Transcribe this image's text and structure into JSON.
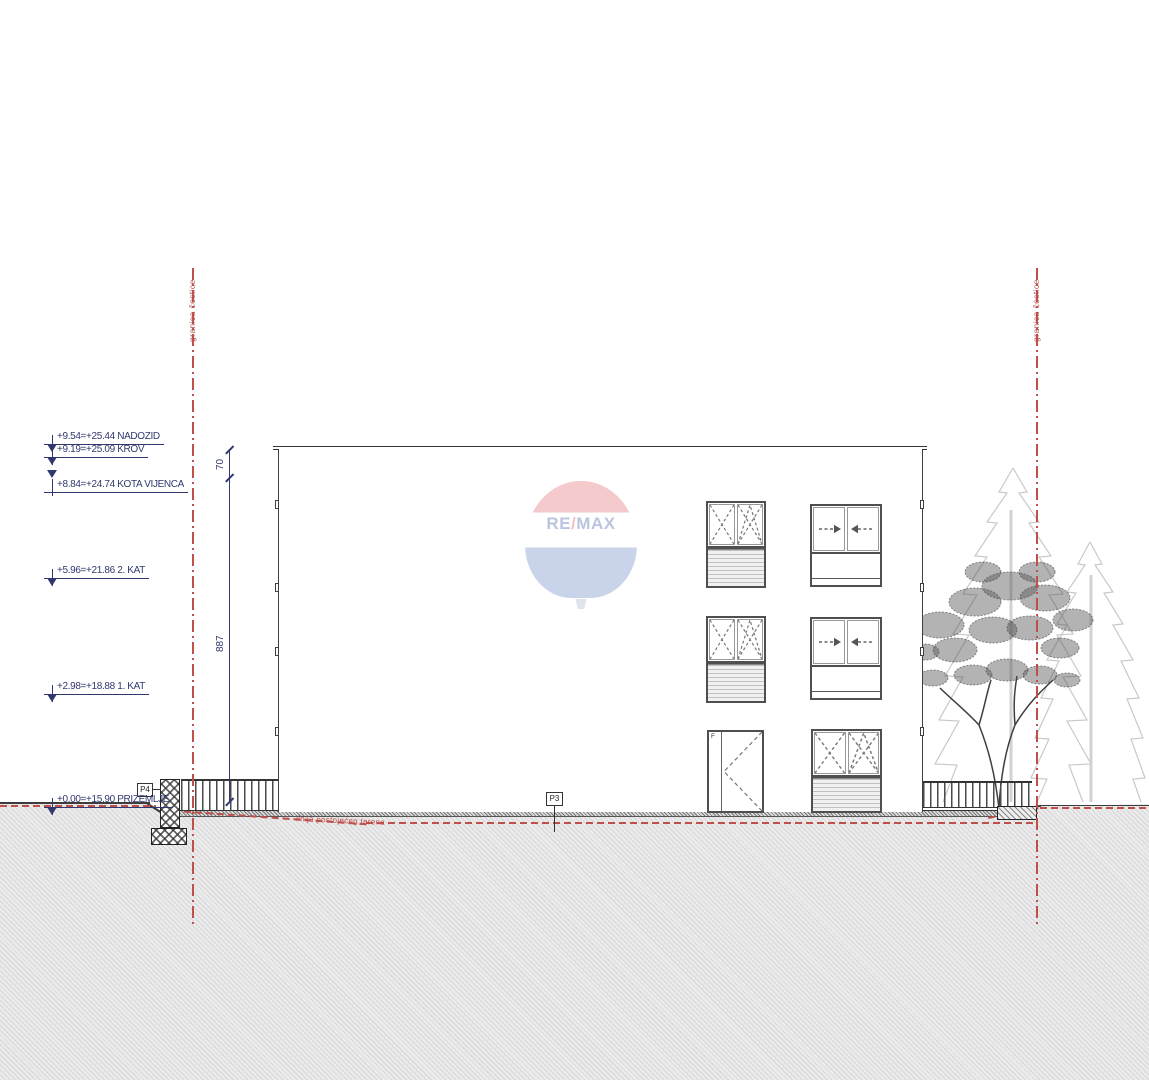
{
  "drawing": {
    "boundary_label": "granica čestice",
    "terrain_line_label": "linija postojećeg terena",
    "elevation_markers": [
      {
        "label": "+9.54=+25.44 NADOZID"
      },
      {
        "label": "+9.19=+25.09 KROV"
      },
      {
        "label": "+8.84=+24.74 KOTA VIJENCA"
      },
      {
        "label": "+5.96=+21.86 2. KAT"
      },
      {
        "label": "+2.98=+18.88 1. KAT"
      },
      {
        "label": "+0.00=+15.90 PRIZEMLJE"
      }
    ],
    "dimensions": {
      "parapet": "70",
      "facade": "887"
    },
    "position_labels": {
      "p3": "P3",
      "p4": "P4",
      "door": "F"
    }
  },
  "watermark": {
    "re": "RE",
    "slash": "/",
    "max": "MAX"
  },
  "colors": {
    "annotation_blue": "#31386f",
    "boundary_red": "#bf4f4a",
    "line_dark": "#3c3c3c",
    "remax_red": "#d94f57",
    "remax_blue": "#4f74bb",
    "remax_text_blue": "#1d3f97"
  }
}
